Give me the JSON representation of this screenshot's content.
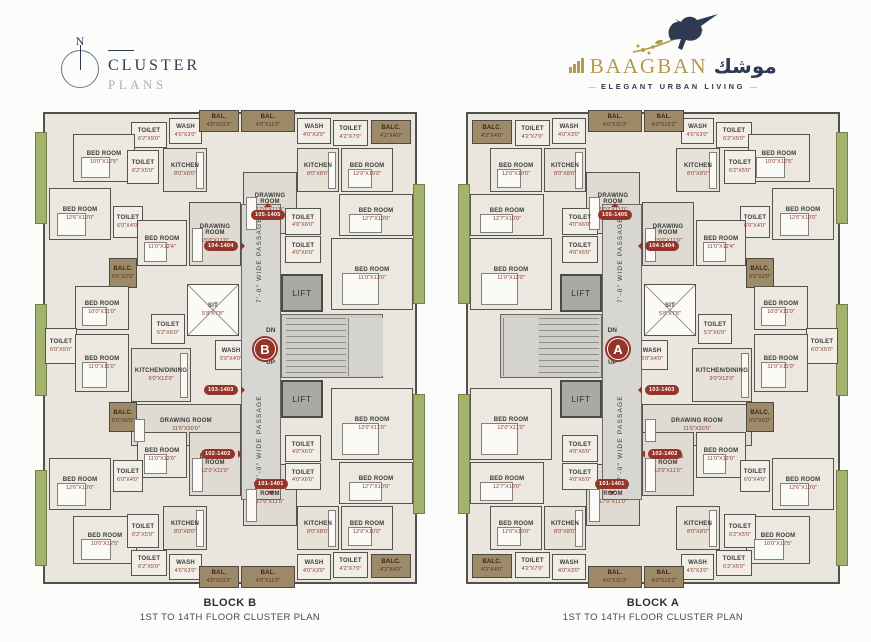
{
  "header": {
    "compass_n": "N",
    "brand": {
      "title": "CLUSTER",
      "subtitle": "PLANS"
    }
  },
  "logo": {
    "name": "BAAGBAN",
    "arabic": "موشك",
    "tagline": "ELEGANT URBAN LIVING",
    "dash": "—"
  },
  "colors": {
    "wall": "#52504b",
    "floor": "#eae6de",
    "floor_dark": "#dfdbd2",
    "balcony_brown": "#9c8a68",
    "balcony_green": "#a3b26c",
    "unit_red": "#94342a",
    "navy": "#2d3a52",
    "gold": "#b5994d"
  },
  "blocks": [
    {
      "id": "B",
      "letter": "B",
      "mirror": false,
      "caption_title": "BLOCK B",
      "caption_sub": "1ST TO 14TH FLOOR CLUSTER PLAN"
    },
    {
      "id": "A",
      "letter": "A",
      "mirror": true,
      "caption_title": "BLOCK A",
      "caption_sub": "1ST TO 14TH FLOOR CLUSTER PLAN"
    }
  ],
  "plan": {
    "core": {
      "passage_label": "7'-0\" WIDE PASSAGE",
      "lift_label": "LIFT",
      "dn": "DN",
      "up": "UP",
      "passage": {
        "x": 206,
        "y": 96,
        "w": 40,
        "h": 296
      },
      "passage_label_pos": [
        {
          "cx": 226,
          "cy": 152
        },
        {
          "cx": 226,
          "cy": 330
        }
      ],
      "lifts": [
        {
          "x": 246,
          "y": 166,
          "w": 42,
          "h": 38
        },
        {
          "x": 246,
          "y": 272,
          "w": 42,
          "h": 38
        }
      ],
      "stairs": {
        "x": 246,
        "y": 206,
        "w": 102,
        "h": 64
      },
      "treads": {
        "x": 250,
        "y": 209,
        "w": 60,
        "h": 58
      },
      "landing": {
        "x": 312,
        "y": 209,
        "w": 34,
        "h": 58
      },
      "dn_y": 12,
      "up_y": 44,
      "letter_pos": {
        "cx": 230,
        "cy": 241
      }
    },
    "badges": [
      {
        "label": "105-1405",
        "cx": 233,
        "cy": 107,
        "dir": "up"
      },
      {
        "label": "104-1404",
        "cx": 186,
        "cy": 138,
        "dir": "right"
      },
      {
        "label": "103-1403",
        "cx": 186,
        "cy": 282,
        "dir": "right"
      },
      {
        "label": "102-1402",
        "cx": 183,
        "cy": 346,
        "dir": "right"
      },
      {
        "label": "101-1401",
        "cx": 236,
        "cy": 376,
        "dir": "down"
      }
    ],
    "greens": [
      {
        "x": 0,
        "y": 24,
        "w": 12,
        "h": 92
      },
      {
        "x": 0,
        "y": 196,
        "w": 12,
        "h": 92
      },
      {
        "x": 0,
        "y": 362,
        "w": 12,
        "h": 96
      },
      {
        "x": 378,
        "y": 76,
        "w": 12,
        "h": 120
      },
      {
        "x": 378,
        "y": 286,
        "w": 12,
        "h": 120
      }
    ],
    "rooms": [
      {
        "n": "TOILET",
        "d": "6'2\"X5'0\"",
        "x": 96,
        "y": 14,
        "w": 36,
        "h": 26,
        "t": "sm"
      },
      {
        "n": "WASH",
        "d": "4'0\"X3'0\"",
        "x": 134,
        "y": 10,
        "w": 33,
        "h": 26,
        "t": "sm"
      },
      {
        "n": "BAL.",
        "d": "4'0\"X10'2\"",
        "x": 164,
        "y": 2,
        "w": 40,
        "h": 22,
        "t": "brown"
      },
      {
        "n": "BAL.",
        "d": "4'0\"X11'0\"",
        "x": 206,
        "y": 2,
        "w": 54,
        "h": 22,
        "t": "brown"
      },
      {
        "n": "WASH",
        "d": "4'0\"X3'0\"",
        "x": 262,
        "y": 10,
        "w": 34,
        "h": 26,
        "t": "sm"
      },
      {
        "n": "TOILET",
        "d": "4'2\"X7'0\"",
        "x": 298,
        "y": 12,
        "w": 35,
        "h": 26,
        "t": "sm"
      },
      {
        "n": "BALC.",
        "d": "4'2\"X4'0\"",
        "x": 336,
        "y": 12,
        "w": 40,
        "h": 24,
        "t": "brown"
      },
      {
        "n": "BED ROOM",
        "d": "10'0\"X12'5\"",
        "x": 38,
        "y": 26,
        "w": 62,
        "h": 48,
        "t": "bed"
      },
      {
        "n": "TOILET",
        "d": "6'2\"X5'0\"",
        "x": 92,
        "y": 42,
        "w": 32,
        "h": 34,
        "t": "sm"
      },
      {
        "n": "KITCHEN",
        "d": "8'0\"X8'0\"",
        "x": 128,
        "y": 40,
        "w": 44,
        "h": 44,
        "t": "kit"
      },
      {
        "n": "BED ROOM",
        "d": "12'6\"X10'0\"",
        "x": 14,
        "y": 80,
        "w": 62,
        "h": 52,
        "t": "bed"
      },
      {
        "n": "TOILET",
        "d": "6'0\"X4'0\"",
        "x": 78,
        "y": 98,
        "w": 30,
        "h": 32,
        "t": "sm"
      },
      {
        "n": "BED ROOM",
        "d": "11'0\"X12'4\"",
        "x": 102,
        "y": 112,
        "w": 50,
        "h": 46,
        "t": "bed"
      },
      {
        "n": "DRAWING ROOM",
        "d": "15'0\"X11'0\"",
        "x": 154,
        "y": 94,
        "w": 52,
        "h": 64,
        "t": "draw"
      },
      {
        "n": "KITCHEN",
        "d": "8'0\"X8'0\"",
        "x": 262,
        "y": 40,
        "w": 42,
        "h": 44,
        "t": "kit"
      },
      {
        "n": "DRAWING ROOM",
        "d": "17'0\"X11'0\"",
        "x": 208,
        "y": 64,
        "w": 54,
        "h": 62,
        "t": "draw"
      },
      {
        "n": "BED ROOM",
        "d": "12'0\"X10'0\"",
        "x": 306,
        "y": 40,
        "w": 52,
        "h": 44,
        "t": "bed"
      },
      {
        "n": "BED ROOM",
        "d": "12'7\"X10'0\"",
        "x": 304,
        "y": 86,
        "w": 74,
        "h": 42,
        "t": "bed"
      },
      {
        "n": "TOILET",
        "d": "4'0\"X6'0\"",
        "x": 250,
        "y": 100,
        "w": 36,
        "h": 27,
        "t": "sm"
      },
      {
        "n": "TOILET",
        "d": "4'0\"X6'0\"",
        "x": 250,
        "y": 128,
        "w": 36,
        "h": 27,
        "t": "sm"
      },
      {
        "n": "BED ROOM",
        "d": "11'0\"X13'0\"",
        "x": 296,
        "y": 130,
        "w": 82,
        "h": 72,
        "t": "bed"
      },
      {
        "n": "BALC.",
        "d": "6'6\"X2'0\"",
        "x": 74,
        "y": 150,
        "w": 28,
        "h": 30,
        "t": "brown"
      },
      {
        "n": "BED ROOM",
        "d": "10'0\"X11'0\"",
        "x": 40,
        "y": 178,
        "w": 54,
        "h": 44,
        "t": "bed"
      },
      {
        "n": "TOILET",
        "d": "6'0\"X5'0\"",
        "x": 10,
        "y": 220,
        "w": 32,
        "h": 36,
        "t": "sm"
      },
      {
        "n": "BED ROOM",
        "d": "11'0\"X11'0\"",
        "x": 40,
        "y": 226,
        "w": 54,
        "h": 58,
        "t": "bed"
      },
      {
        "n": "SIT",
        "d": "5'8\"X7'8\"",
        "x": 152,
        "y": 176,
        "w": 52,
        "h": 52,
        "t": "duct"
      },
      {
        "n": "TOILET",
        "d": "5'2\"X6'0\"",
        "x": 116,
        "y": 206,
        "w": 34,
        "h": 30,
        "t": "sm"
      },
      {
        "n": "KITCHEN/DINING",
        "d": "9'0\"X12'0\"",
        "x": 96,
        "y": 240,
        "w": 60,
        "h": 54,
        "t": "kit"
      },
      {
        "n": "WASH",
        "d": "5'0\"X4'0\"",
        "x": 180,
        "y": 232,
        "w": 32,
        "h": 30,
        "t": "sm"
      },
      {
        "n": "DRAWING ROOM",
        "d": "11'6\"X20'0\"",
        "x": 96,
        "y": 296,
        "w": 110,
        "h": 42,
        "t": "draw"
      },
      {
        "n": "BALC.",
        "d": "6'0\"X6'0\"",
        "x": 74,
        "y": 294,
        "w": 28,
        "h": 30,
        "t": "brown"
      },
      {
        "n": "BED ROOM",
        "d": "11'0\"X12'0\"",
        "x": 102,
        "y": 324,
        "w": 50,
        "h": 46,
        "t": "bed"
      },
      {
        "n": "DRAWING ROOM",
        "d": "12'0\"X11'0\"",
        "x": 154,
        "y": 324,
        "w": 52,
        "h": 64,
        "t": "draw"
      },
      {
        "n": "BED ROOM",
        "d": "12'6\"X10'0\"",
        "x": 14,
        "y": 350,
        "w": 62,
        "h": 52,
        "t": "bed"
      },
      {
        "n": "TOILET",
        "d": "6'0\"X4'0\"",
        "x": 78,
        "y": 352,
        "w": 30,
        "h": 32,
        "t": "sm"
      },
      {
        "n": "BED ROOM",
        "d": "10'0\"X12'5\"",
        "x": 38,
        "y": 408,
        "w": 64,
        "h": 48,
        "t": "bed"
      },
      {
        "n": "TOILET",
        "d": "6'2\"X5'0\"",
        "x": 92,
        "y": 406,
        "w": 32,
        "h": 34,
        "t": "sm"
      },
      {
        "n": "KITCHEN",
        "d": "8'0\"X8'0\"",
        "x": 128,
        "y": 398,
        "w": 44,
        "h": 44,
        "t": "kit"
      },
      {
        "n": "TOILET",
        "d": "6'2\"X5'0\"",
        "x": 96,
        "y": 442,
        "w": 36,
        "h": 26,
        "t": "sm"
      },
      {
        "n": "WASH",
        "d": "4'0\"X3'0\"",
        "x": 134,
        "y": 446,
        "w": 33,
        "h": 26,
        "t": "sm"
      },
      {
        "n": "DRAWING ROOM",
        "d": "17'0\"X11'0\"",
        "x": 208,
        "y": 356,
        "w": 54,
        "h": 62,
        "t": "draw"
      },
      {
        "n": "KITCHEN",
        "d": "8'0\"X8'0\"",
        "x": 262,
        "y": 398,
        "w": 42,
        "h": 44,
        "t": "kit"
      },
      {
        "n": "TOILET",
        "d": "4'0\"X6'0\"",
        "x": 250,
        "y": 327,
        "w": 36,
        "h": 27,
        "t": "sm"
      },
      {
        "n": "TOILET",
        "d": "4'0\"X6'0\"",
        "x": 250,
        "y": 355,
        "w": 36,
        "h": 27,
        "t": "sm"
      },
      {
        "n": "BED ROOM",
        "d": "12'0\"X11'0\"",
        "x": 296,
        "y": 280,
        "w": 82,
        "h": 72,
        "t": "bed"
      },
      {
        "n": "BED ROOM",
        "d": "12'7\"X10'0\"",
        "x": 304,
        "y": 354,
        "w": 74,
        "h": 42,
        "t": "bed"
      },
      {
        "n": "BED ROOM",
        "d": "12'0\"X10'0\"",
        "x": 306,
        "y": 398,
        "w": 52,
        "h": 44,
        "t": "bed"
      },
      {
        "n": "WASH",
        "d": "4'0\"X3'0\"",
        "x": 262,
        "y": 446,
        "w": 34,
        "h": 26,
        "t": "sm"
      },
      {
        "n": "TOILET",
        "d": "4'2\"X7'0\"",
        "x": 298,
        "y": 444,
        "w": 35,
        "h": 26,
        "t": "sm"
      },
      {
        "n": "BAL.",
        "d": "4'0\"X10'2\"",
        "x": 164,
        "y": 458,
        "w": 40,
        "h": 22,
        "t": "brown"
      },
      {
        "n": "BAL.",
        "d": "4'0\"X11'0\"",
        "x": 206,
        "y": 458,
        "w": 54,
        "h": 22,
        "t": "brown"
      },
      {
        "n": "BALC.",
        "d": "4'2\"X4'0\"",
        "x": 336,
        "y": 446,
        "w": 40,
        "h": 24,
        "t": "brown"
      }
    ]
  }
}
